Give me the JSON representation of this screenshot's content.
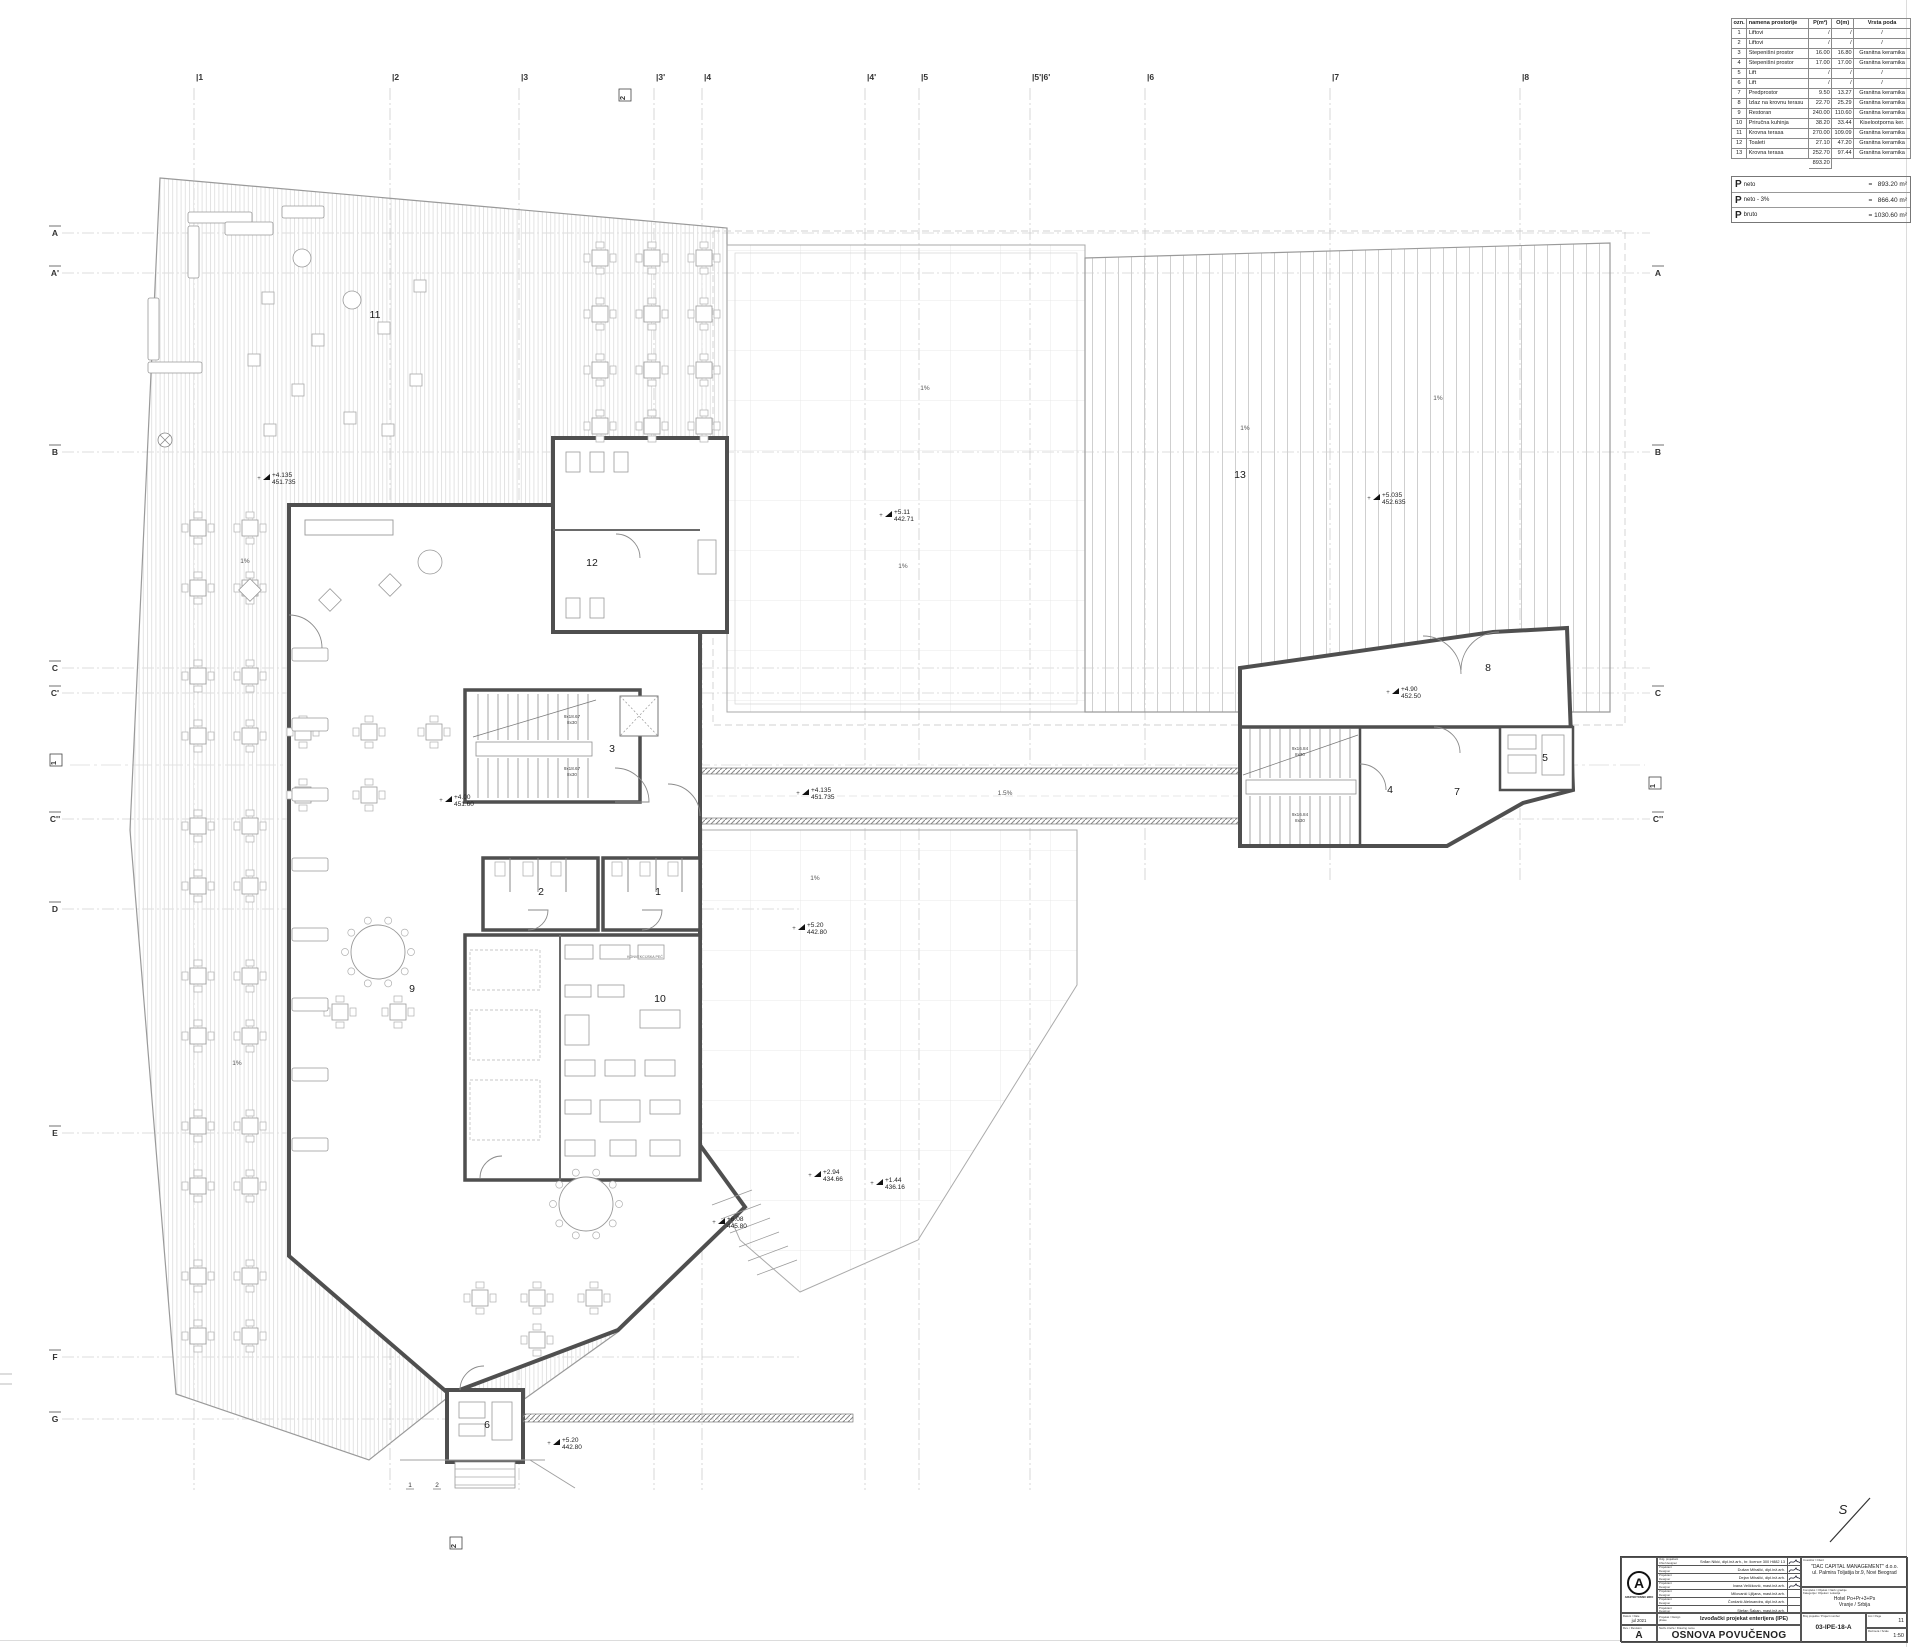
{
  "legend_table": {
    "headers": [
      "ozn.",
      "namena prostorije",
      "P(m²)",
      "O(m)",
      "Vrsta poda"
    ],
    "rows": [
      [
        "1",
        "Liftovi",
        "/",
        "/",
        "/"
      ],
      [
        "2",
        "Liftovi",
        "/",
        "/",
        "/"
      ],
      [
        "3",
        "Stepenišni prostor",
        "16.00",
        "16.80",
        "Granitna keramika"
      ],
      [
        "4",
        "Stepenišni prostor",
        "17.00",
        "17.00",
        "Granitna keramika"
      ],
      [
        "5",
        "Lift",
        "/",
        "/",
        "/"
      ],
      [
        "6",
        "Lift",
        "/",
        "/",
        "/"
      ],
      [
        "7",
        "Predprostor",
        "9.50",
        "13.27",
        "Granitna keramika"
      ],
      [
        "8",
        "Izlaz na krovnu terasu",
        "22.70",
        "25.29",
        "Granitna keramika"
      ],
      [
        "9",
        "Restoran",
        "240.00",
        "110.60",
        "Granitna keramika"
      ],
      [
        "10",
        "Priručna kuhinja",
        "38.20",
        "33.44",
        "Kiselootporna ker."
      ],
      [
        "11",
        "Krovna terasa",
        "270.00",
        "109.09",
        "Granitna keramika"
      ],
      [
        "12",
        "Toaleti",
        "27.10",
        "47.20",
        "Granitna keramika"
      ],
      [
        "13",
        "Krovna terasa",
        "252.70",
        "97.44",
        "Granitna keramika"
      ]
    ],
    "total": "893.20"
  },
  "area_summary": {
    "rows": [
      {
        "sym": "P",
        "sub": "neto",
        "val": "=   893.20 m²"
      },
      {
        "sym": "P",
        "sub": "neto - 3%",
        "val": "=   866.40 m²"
      },
      {
        "sym": "P",
        "sub": "bruto",
        "val": "= 1030.60 m²"
      }
    ]
  },
  "title_block": {
    "logo_letter": "A",
    "logo_caption": "ARHITEKTONSKI BIRO",
    "designers": [
      {
        "role": "Odg. projektant / Chief designer",
        "name": "Srđan Nikić, dipl.inž.arh., br. licence 300 H882 13",
        "signed": true
      },
      {
        "role": "Projektant / Designer",
        "name": "Dušan Mihailić, dipl.inž.arh.",
        "signed": true
      },
      {
        "role": "Projektant / Designer",
        "name": "Dejan Mihailić, dipl.inž.arh.",
        "signed": true
      },
      {
        "role": "Projektant / Designer",
        "name": "Ivana Veličković, mast.inž.arh.",
        "signed": true
      },
      {
        "role": "Projektant / Designer",
        "name": "Milovanić Ljiljana, mast.inž.arh.",
        "signed": false
      },
      {
        "role": "Projektant / Designer",
        "name": "Čordarić Aleksandra, dipl.inž.arh.",
        "signed": false
      },
      {
        "role": "Projektant / Designer",
        "name": "Stefan Šakan, mast.inž.arh.",
        "signed": false
      }
    ],
    "date_label": "Datum / Date",
    "date": "jul 2021",
    "rev_label": "Rev. / Revision",
    "revision": "A",
    "phase_label": "Projekat / Design phase",
    "phase_value": "Izvođački projekat enterijera (IPE)",
    "drawing_name_label": "Naziv crteža / Drawing name",
    "drawing_name": "OSNOVA POVUČENOG SPRATA",
    "client_label": "Investitor / Client",
    "client_name": "\"DAC CAPITAL MANAGEMENT\" d.o.o.",
    "client_address": "ul. Palmira Toljatija br.9, Novi Beograd",
    "object_label1": "Kompleks / Objekat / Naziv gradnje",
    "object_label2": "Kategorija / Objekat / Lokacija",
    "object_name": "Hotel Po+Pr+3+Ps",
    "object_location": "Vranje / Srbija",
    "number_label": "Broj projekta / Project number",
    "drawing_number": "03-IPE-18-A",
    "page_label": "List / Page",
    "page": "11",
    "scale_label": "Razmera / Scale",
    "scale": "1:50"
  },
  "plan": {
    "x_axes": [
      {
        "label": "|1",
        "x": 194
      },
      {
        "label": "|2",
        "x": 390
      },
      {
        "label": "|3",
        "x": 519
      },
      {
        "label": "|3'",
        "x": 654
      },
      {
        "label": "|4",
        "x": 702
      },
      {
        "label": "|4'",
        "x": 865
      },
      {
        "label": "|5",
        "x": 919
      },
      {
        "label": "|5'|6'",
        "x": 1030
      },
      {
        "label": "|6",
        "x": 1145
      },
      {
        "label": "|7",
        "x": 1330
      },
      {
        "label": "|8",
        "x": 1520
      }
    ],
    "y_axes_left": [
      {
        "label": "A",
        "y": 233
      },
      {
        "label": "A'",
        "y": 273
      },
      {
        "label": "B",
        "y": 452
      },
      {
        "label": "C",
        "y": 668
      },
      {
        "label": "C'",
        "y": 693
      },
      {
        "label": "C''",
        "y": 819
      },
      {
        "label": "D",
        "y": 909
      },
      {
        "label": "E",
        "y": 1133
      },
      {
        "label": "F",
        "y": 1357
      },
      {
        "label": "G",
        "y": 1419
      }
    ],
    "y_axes_right": [
      {
        "label": "A",
        "y": 273
      },
      {
        "label": "B",
        "y": 452
      },
      {
        "label": "C",
        "y": 693
      },
      {
        "label": "C''",
        "y": 819
      }
    ],
    "section_boxes": [
      {
        "label": "2",
        "x": 625,
        "y": 95
      },
      {
        "label": "2",
        "x": 456,
        "y": 1543
      },
      {
        "label": "1",
        "x": 56,
        "y": 760
      },
      {
        "label": "1",
        "x": 1655,
        "y": 783
      }
    ],
    "sub_labels": [
      {
        "label": "1",
        "x": 410,
        "y": 1487
      },
      {
        "label": "2",
        "x": 437,
        "y": 1487
      },
      {
        "label": "5",
        "x": 588,
        "y": 709
      },
      {
        "label": "6",
        "x": 607,
        "y": 709
      }
    ],
    "rooms": [
      {
        "n": "11",
        "x": 375,
        "y": 318
      },
      {
        "n": "12",
        "x": 592,
        "y": 566
      },
      {
        "n": "3",
        "x": 612,
        "y": 752
      },
      {
        "n": "13",
        "x": 1240,
        "y": 478
      },
      {
        "n": "8",
        "x": 1488,
        "y": 671
      },
      {
        "n": "5",
        "x": 1545,
        "y": 761
      },
      {
        "n": "4",
        "x": 1390,
        "y": 793
      },
      {
        "n": "7",
        "x": 1457,
        "y": 795
      },
      {
        "n": "2",
        "x": 541,
        "y": 895
      },
      {
        "n": "1",
        "x": 658,
        "y": 895
      },
      {
        "n": "9",
        "x": 412,
        "y": 992
      },
      {
        "n": "10",
        "x": 660,
        "y": 1002
      },
      {
        "n": "6",
        "x": 487,
        "y": 1428
      }
    ],
    "elevations": [
      {
        "x": 268,
        "y": 478,
        "a": "+4.135",
        "b": "451.735"
      },
      {
        "x": 890,
        "y": 515,
        "a": "+5.11",
        "b": "442.71"
      },
      {
        "x": 1378,
        "y": 498,
        "a": "+5.035",
        "b": "452.635"
      },
      {
        "x": 1397,
        "y": 692,
        "a": "+4.90",
        "b": "452.50"
      },
      {
        "x": 807,
        "y": 793,
        "a": "+4.135",
        "b": "451.735"
      },
      {
        "x": 450,
        "y": 800,
        "a": "+4.00",
        "b": "451.60"
      },
      {
        "x": 803,
        "y": 928,
        "a": "+5.20",
        "b": "442.80"
      },
      {
        "x": 819,
        "y": 1175,
        "a": "+2.94",
        "b": "434.66"
      },
      {
        "x": 881,
        "y": 1183,
        "a": "+1.44",
        "b": "436.16"
      },
      {
        "x": 723,
        "y": 1222,
        "a": "+6.08",
        "b": "445.80"
      },
      {
        "x": 558,
        "y": 1443,
        "a": "+5.20",
        "b": "442.80"
      }
    ],
    "stair_labels": [
      {
        "x": 572,
        "y": 718,
        "l1": "9x18.67",
        "l2": "8x30"
      },
      {
        "x": 572,
        "y": 770,
        "l1": "9x18.67",
        "l2": "8x30"
      },
      {
        "x": 1300,
        "y": 750,
        "l1": "9x16.84",
        "l2": "8x30"
      },
      {
        "x": 1300,
        "y": 816,
        "l1": "9x16.84",
        "l2": "8x30"
      }
    ],
    "slope_labels": [
      {
        "t": "1%",
        "x": 245,
        "y": 563
      },
      {
        "t": "1%",
        "x": 237,
        "y": 1065
      },
      {
        "t": "1%",
        "x": 925,
        "y": 390
      },
      {
        "t": "1%",
        "x": 903,
        "y": 568
      },
      {
        "t": "1%",
        "x": 1245,
        "y": 430
      },
      {
        "t": "1%",
        "x": 1438,
        "y": 400
      },
      {
        "t": "1%",
        "x": 815,
        "y": 880
      },
      {
        "t": "1.5%",
        "x": 1005,
        "y": 795
      }
    ],
    "annotations": [
      {
        "text": "KONVEKCIJSKA PEĆ",
        "x": 645,
        "y": 958
      }
    ],
    "north_label": "S"
  }
}
